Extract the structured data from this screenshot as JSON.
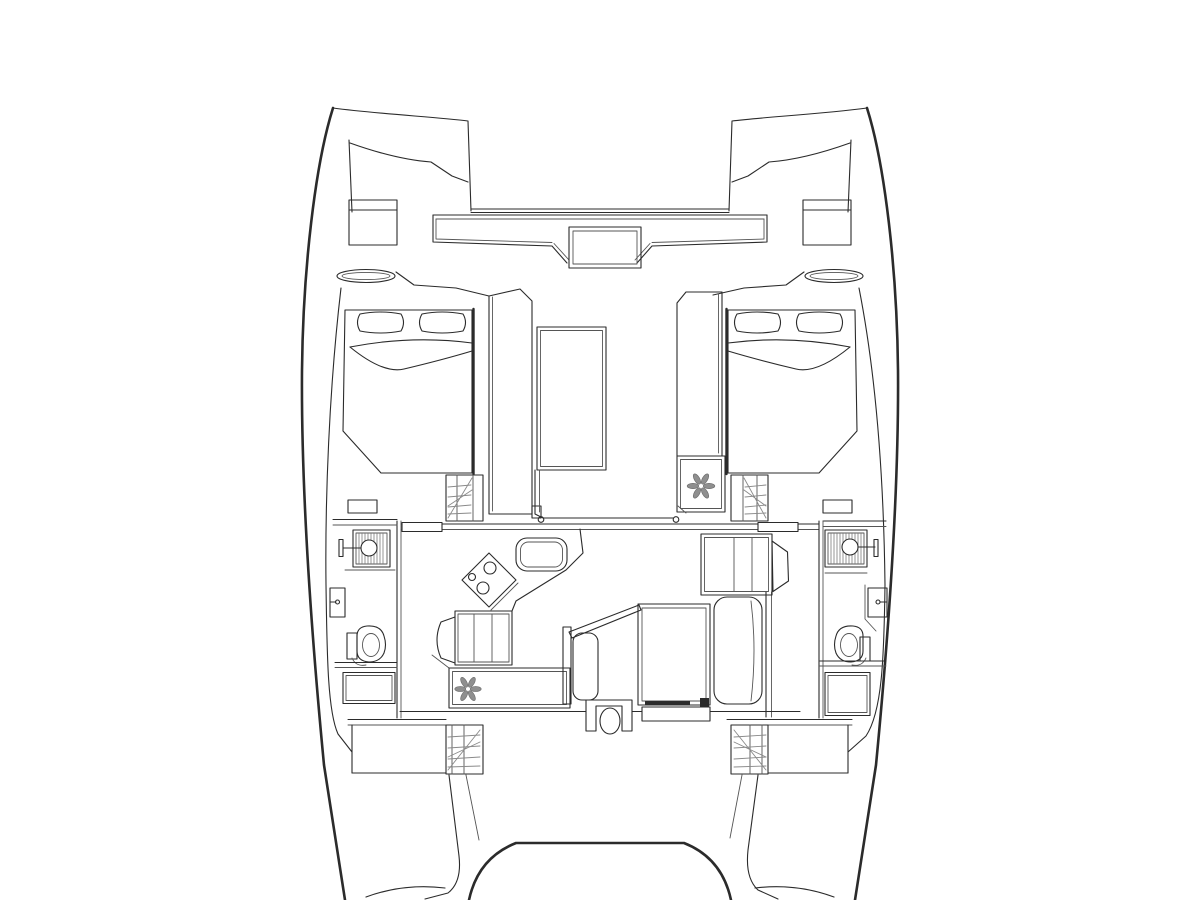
{
  "diagram": {
    "title": "Catamaran deck plan - interior layout (top view)",
    "type": "floor-plan-line-drawing",
    "colors": {
      "background": "#ffffff",
      "line": "#2b2b2b",
      "thin_line": "#555555",
      "hatch": "#8a8a8a",
      "icon_gray": "#8f8f8f"
    },
    "icons": [
      {
        "name": "snowflake-icon",
        "meaning": "refrigerator/freezer",
        "count": 2
      },
      {
        "name": "stove-burners-icon",
        "meaning": "3-burner hob",
        "count": 1
      },
      {
        "name": "shower-head-icon",
        "meaning": "shower",
        "count": 2
      },
      {
        "name": "toilet-icon",
        "meaning": "marine toilet",
        "count": 2
      },
      {
        "name": "faucet-icon",
        "meaning": "wash basin tap",
        "count": 2
      }
    ],
    "features": [
      "port-hull-outline",
      "starboard-hull-outline",
      "port-bow-locker",
      "starboard-bow-locker",
      "port-bow-hatch",
      "starboard-bow-hatch",
      "foredeck-crossbeam",
      "anchor-locker-box",
      "forward-cockpit-skylight",
      "port-forward-cabin-double-berth",
      "starboard-forward-cabin-double-berth",
      "port-companionway-steps",
      "starboard-companionway-steps",
      "galley-counter",
      "galley-stove",
      "galley-sink",
      "galley-drawers",
      "galley-refrigerator",
      "under-counter-refrigerator",
      "sliding-door-track",
      "dinette-table",
      "dinette-port-bench",
      "dinette-starboard-bench",
      "helm-seat",
      "chart-cabinet",
      "port-head-shower",
      "port-head-sink",
      "port-head-toilet",
      "port-head-cabinet",
      "starboard-head-shower",
      "starboard-head-sink",
      "starboard-head-toilet",
      "starboard-head-cabinet",
      "port-aft-steps",
      "starboard-aft-steps",
      "aft-cockpit-coaming",
      "transom-curves"
    ]
  }
}
